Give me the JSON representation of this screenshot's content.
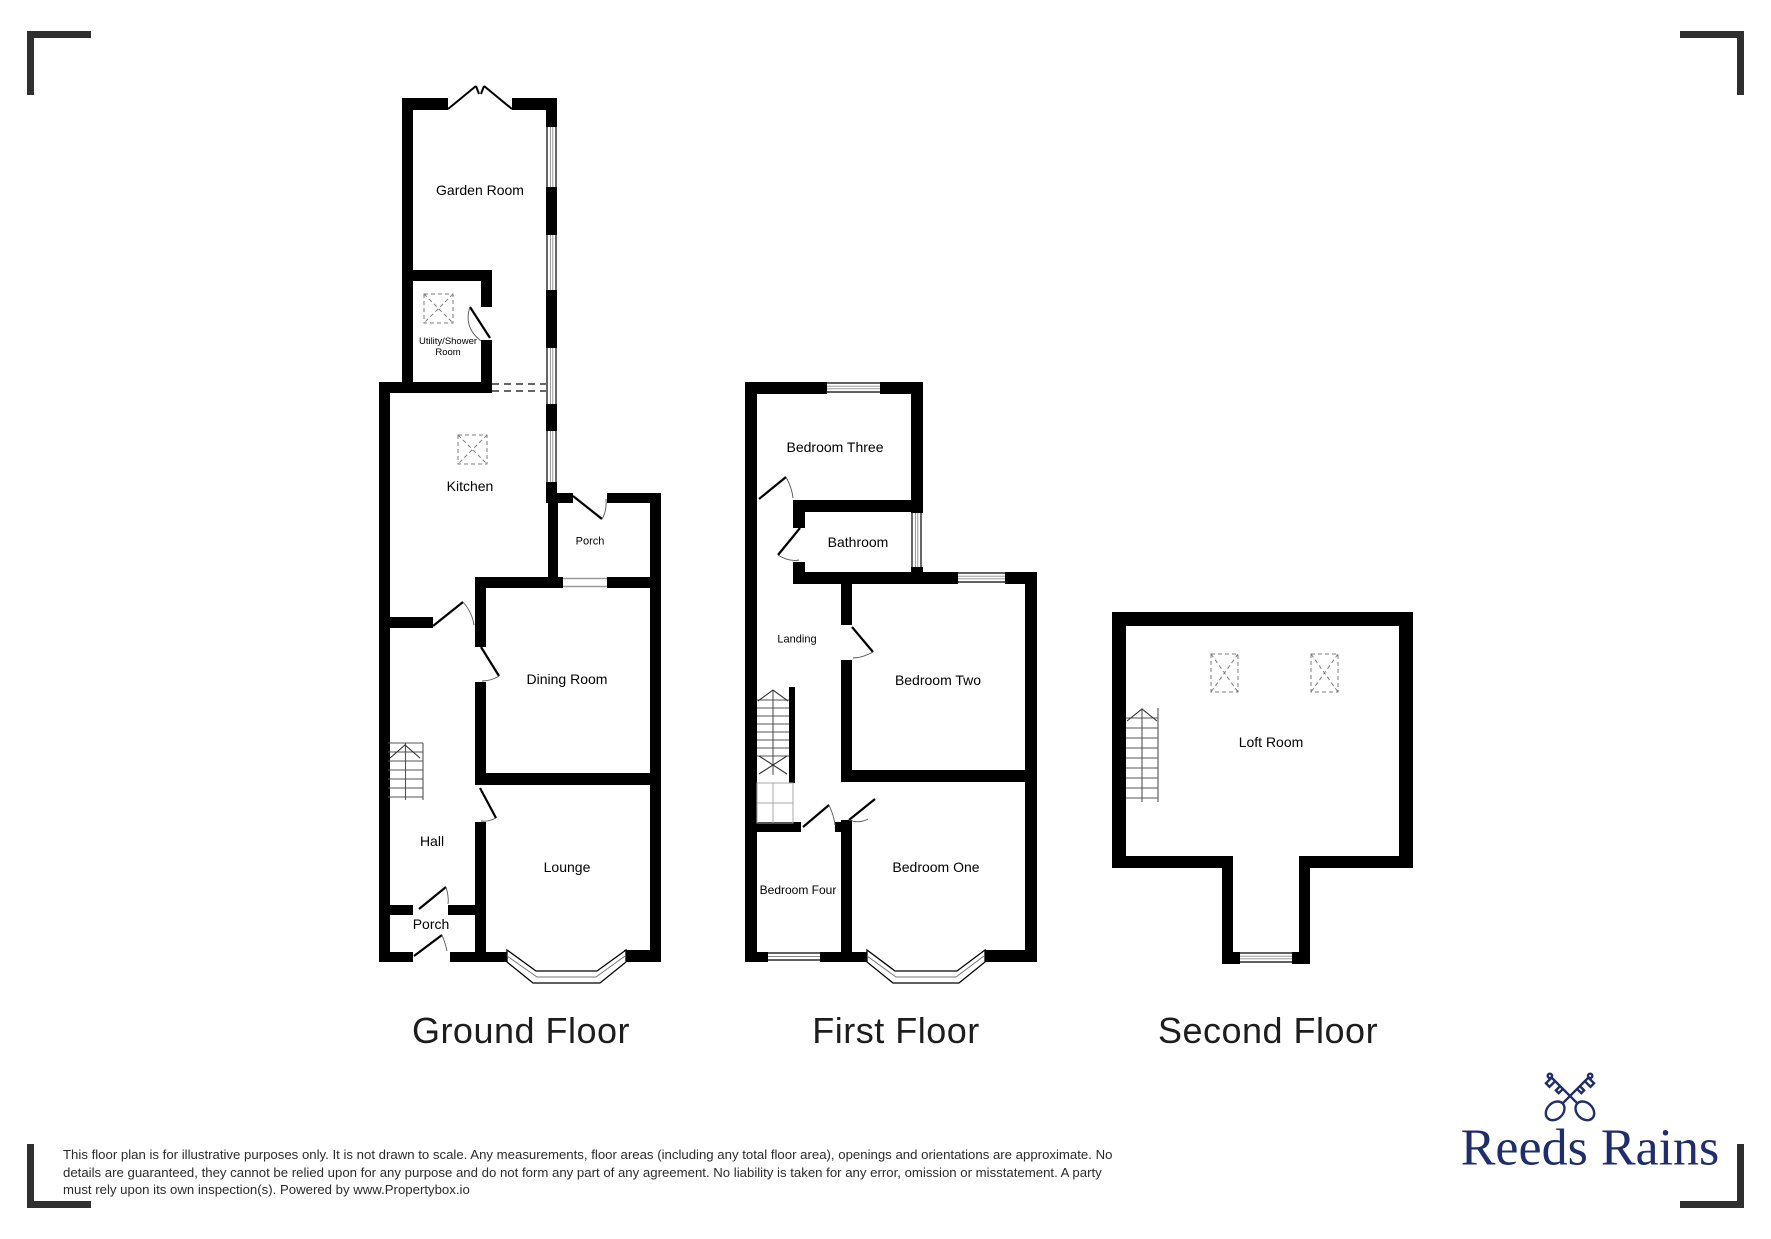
{
  "floors": {
    "ground": {
      "title": "Ground Floor",
      "rooms": {
        "garden_room": "Garden Room",
        "utility": "Utility/Shower Room",
        "kitchen": "Kitchen",
        "porch_upper": "Porch",
        "dining": "Dining Room",
        "hall": "Hall",
        "lounge": "Lounge",
        "porch_lower": "Porch"
      }
    },
    "first": {
      "title": "First Floor",
      "rooms": {
        "bedroom_three": "Bedroom Three",
        "bathroom": "Bathroom",
        "landing": "Landing",
        "bedroom_two": "Bedroom Two",
        "bedroom_four": "Bedroom Four",
        "bedroom_one": "Bedroom One"
      }
    },
    "second": {
      "title": "Second Floor",
      "rooms": {
        "loft": "Loft Room"
      }
    }
  },
  "disclaimer": {
    "lines": [
      "This floor plan is for illustrative purposes only. It is not drawn to scale. Any measurements, floor areas (including any total floor area), openings and orientations are approximate. No",
      "details are guaranteed, they cannot be relied upon for any purpose and do not form any part of any agreement. No liability is taken for any error, omission or misstatement. A party",
      "must rely upon its own inspection(s). Powered by www.Propertybox.io"
    ]
  },
  "brand": {
    "name": "Reeds Rains",
    "logo_icon": "crossed-keys-icon",
    "color": "#1f2d6b"
  },
  "colors": {
    "wall": "#000000",
    "background": "#ffffff",
    "corner_marks": "#2f2f2f"
  }
}
